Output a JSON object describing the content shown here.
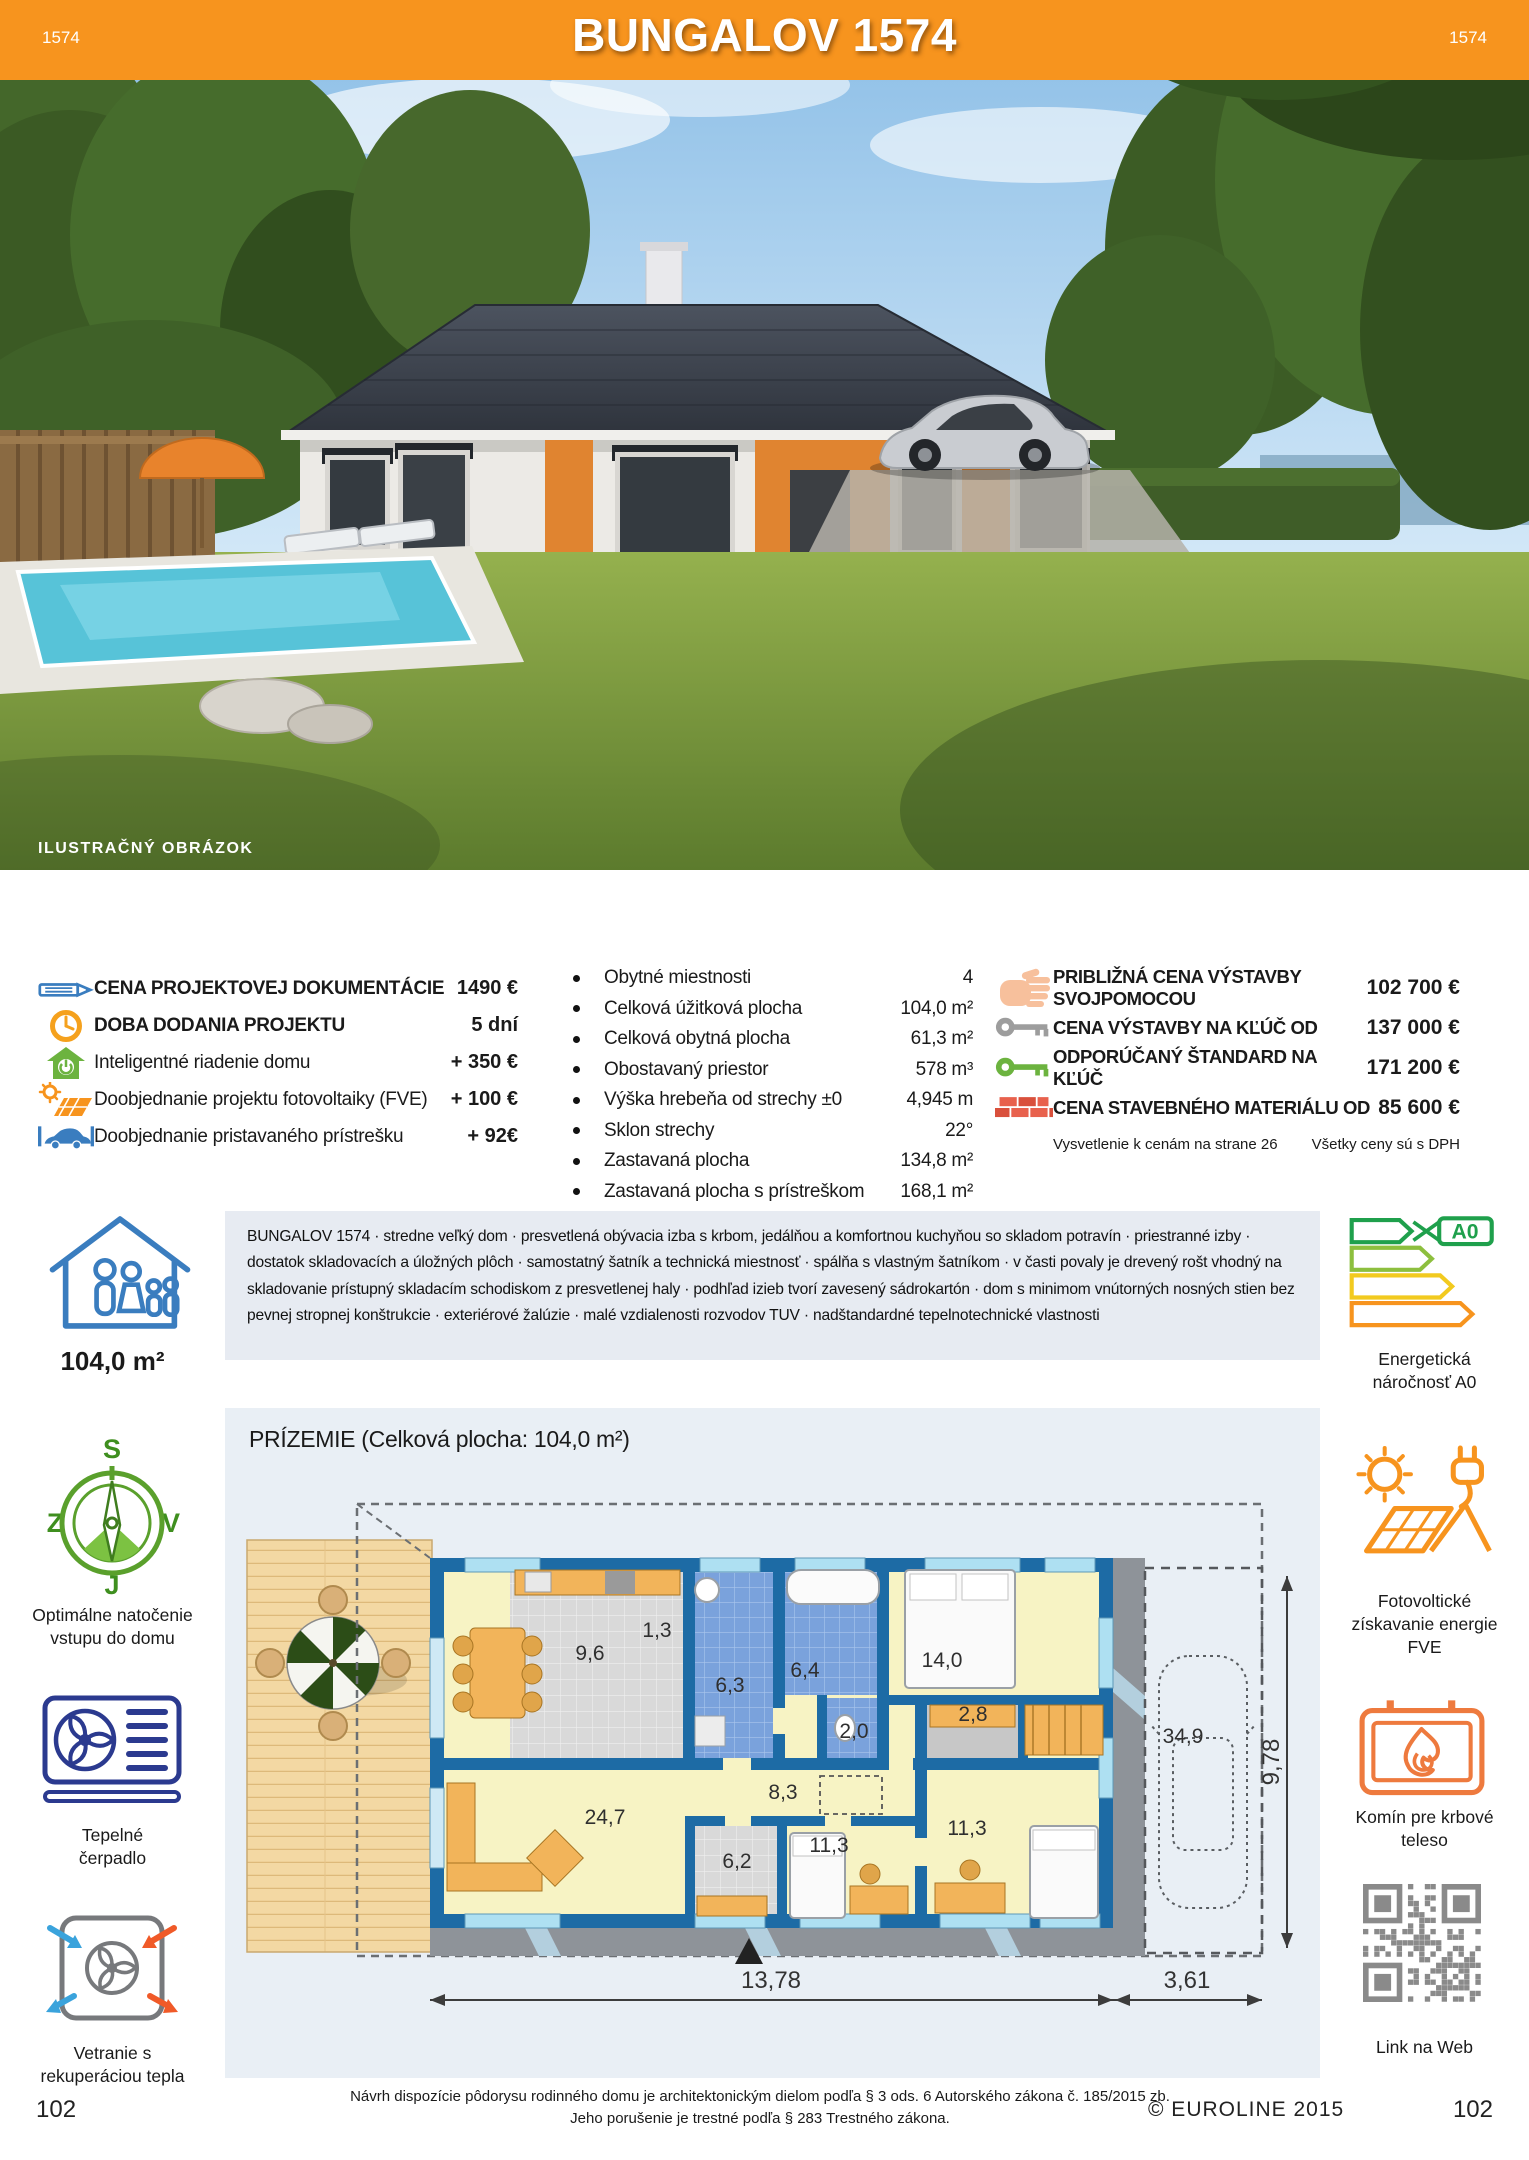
{
  "colors": {
    "accent_orange": "#F7941E",
    "description_panel": "#E7EBF2",
    "plan_panel": "#E9EFF5",
    "wall_blue": "#1D6BA5"
  },
  "logo": {
    "text": "EUROLINE"
  },
  "photo": {
    "caption": "ILUSTRAČNÝ OBRÁZOK"
  },
  "banner": {
    "code_left": "1574",
    "title": "BUNGALOV 1574",
    "code_right": "1574"
  },
  "pricing_left": {
    "items": [
      {
        "icon": "pencil-icon",
        "label": "CENA PROJEKTOVEJ DOKUMENTÁCIE",
        "value": "1490 €"
      },
      {
        "icon": "clock-icon",
        "label": "DOBA DODANIA PROJEKTU",
        "value": "5 dní"
      },
      {
        "icon": "smart-home-icon",
        "label": "Inteligentné riadenie domu",
        "value": "+ 350 €"
      },
      {
        "icon": "solar-order-icon",
        "label": "Doobjednanie projektu fotovoltaiky (FVE)",
        "value": "+ 100 €"
      },
      {
        "icon": "carport-order-icon",
        "label": "Doobjednanie pristavaného prístrešku",
        "value": "+ 92€"
      }
    ]
  },
  "specs": {
    "items": [
      {
        "label": "Obytné miestnosti",
        "value": "4"
      },
      {
        "label": "Celková úžitková plocha",
        "value": "104,0 m²"
      },
      {
        "label": "Celková obytná plocha",
        "value": "61,3 m²"
      },
      {
        "label": "Obostavaný priestor",
        "value": "578 m³"
      },
      {
        "label": "Výška hrebeňa od strechy ±0",
        "value": "4,945 m"
      },
      {
        "label": "Sklon strechy",
        "value": "22°"
      },
      {
        "label": "Zastavaná plocha",
        "value": "134,8 m²"
      },
      {
        "label": "Zastavaná plocha s prístreškom",
        "value": "168,1 m²"
      }
    ]
  },
  "pricing_right": {
    "items": [
      {
        "icon": "hand-icon",
        "label": "PRIBLIŽNÁ CENA VÝSTAVBY SVOJPOMOCOU",
        "value": "102 700 €"
      },
      {
        "icon": "key-gray-icon",
        "label": "CENA VÝSTAVBY NA KĽÚČ OD",
        "value": "137 000 €"
      },
      {
        "icon": "key-green-icon",
        "label": "ODPORÚČANÝ ŠTANDARD NA KĽÚČ",
        "value": "171 200 €"
      },
      {
        "icon": "bricks-icon",
        "label": "CENA STAVEBNÉHO MATERIÁLU OD",
        "value": "85 600 €"
      }
    ],
    "note_left": "Vysvetlenie k cenám na strane 26",
    "note_right": "Všetky ceny sú s DPH"
  },
  "description": {
    "text": "BUNGALOV 1574 · stredne veľký dom · presvetlená obývacia izba s krbom, jedálňou a komfortnou kuchyňou so skladom potravín · priestranné izby · dostatok skladovacích a úložných plôch · samostatný šatník a technická miestnosť · spálňa s vlastným šatníkom · v časti povaly je drevený rošt vhodný na skladovanie prístupný skladacím schodiskom z presvetlenej haly · podhľad izieb tvorí zavesený sádrokartón · dom s minimom vnútorných nosných stien bez pevnej stropnej konštrukcie · exteriérové žalúzie · malé vzdialenosti rozvodov TUV · nadštandardné tepelnotechnické vlastnosti"
  },
  "sidebar_left": {
    "area": "104,0 m²",
    "compass_label": "Optimálne natočenie\nvstupu do domu",
    "heatpump_label": "Tepelné\nčerpadlo",
    "ventilation_label": "Vetranie s\nrekuperáciou tepla",
    "page_number": "102"
  },
  "sidebar_right": {
    "energy_class": "A0",
    "energy_label": "Energetická\nnáročnosť A0",
    "pv_label": "Fotovoltické\nzískavanie energie\nFVE",
    "chimney_label": "Komín pre krbové\nteleso",
    "qr_label": "Link na Web",
    "page_number": "102"
  },
  "floorplan": {
    "title": "PRÍZEMIE (Celková plocha: 104,0 m²)",
    "rooms": [
      {
        "area": "9,6"
      },
      {
        "area": "1,3"
      },
      {
        "area": "6,3"
      },
      {
        "area": "6,4"
      },
      {
        "area": "2,0"
      },
      {
        "area": "14,0"
      },
      {
        "area": "2,8"
      },
      {
        "area": "8,3"
      },
      {
        "area": "24,7"
      },
      {
        "area": "6,2"
      },
      {
        "area": "11,3"
      },
      {
        "area": "11,3"
      },
      {
        "area": "34,9"
      }
    ],
    "dimensions": {
      "width_house": "13,78",
      "width_carport": "3,61",
      "depth": "9,78"
    }
  },
  "footer": {
    "line1": "Návrh dispozície pôdorysu rodinného domu je architektonickým dielom podľa § 3 ods. 6 Autorského zákona č. 185/2015 zb.",
    "line2": "Jeho porušenie je trestné podľa § 283 Trestného zákona.",
    "copyright": "© EUROLINE 2015",
    "page_left": "102",
    "page_right": "102"
  }
}
